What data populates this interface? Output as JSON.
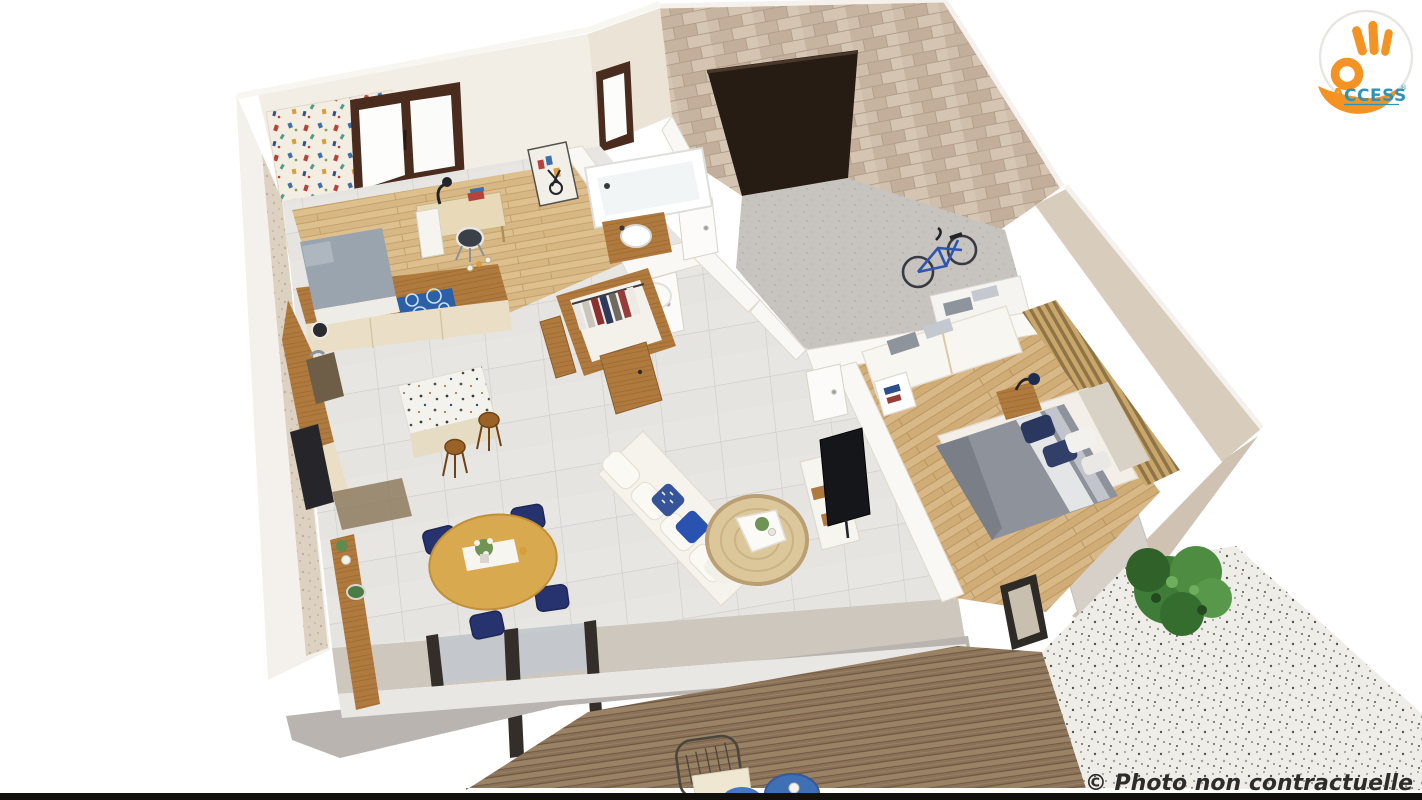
{
  "logo": {
    "icon": "ok-hand-icon",
    "letter_accent": "A",
    "letters_rest": "CCESS",
    "registered": "®",
    "colors": {
      "hand": "#F49222",
      "text_accent": "#F49222",
      "text_rest": "#2D93B8",
      "circle_bg": "#FFFFFF",
      "ring": "#E8E6E2"
    }
  },
  "watermark": {
    "text": "© Photo non contractuelle",
    "color": "#2E2C2A"
  },
  "palette": {
    "background": "#FFFFFF",
    "bottom_bar": "#12100D",
    "stone_wall": "#CDBCA9",
    "wall_top": "#D8CCBC",
    "interior_wall": "#F2EDE5",
    "concrete_wall": "#CEC7BE",
    "concrete_face": "#B9B4AF",
    "tile_floor": "#E8E6E3",
    "garage_floor": "#C7C4C0",
    "garage_door": "#261C14",
    "window_frame": "#4A2C1E",
    "kitchen_wood": "#C99A52",
    "cabinet_cream": "#EADFC6",
    "cooktop_blue": "#2B5FA8",
    "dining_table": "#D8A94E",
    "chair_navy": "#26336E",
    "sofa_white": "#F6F3EC",
    "rug_tan": "#DCC79B",
    "duvet_gray": "#8D929B",
    "pillow_navy": "#2A3860",
    "slat_wood": "#C9A76B",
    "deck_wood": "#9A8265",
    "gravel": "#EFEDE8",
    "bush_green": "#3E7C38",
    "bike_blue": "#2F55B0",
    "outdoor_table_blue": "#3F6FB5"
  }
}
